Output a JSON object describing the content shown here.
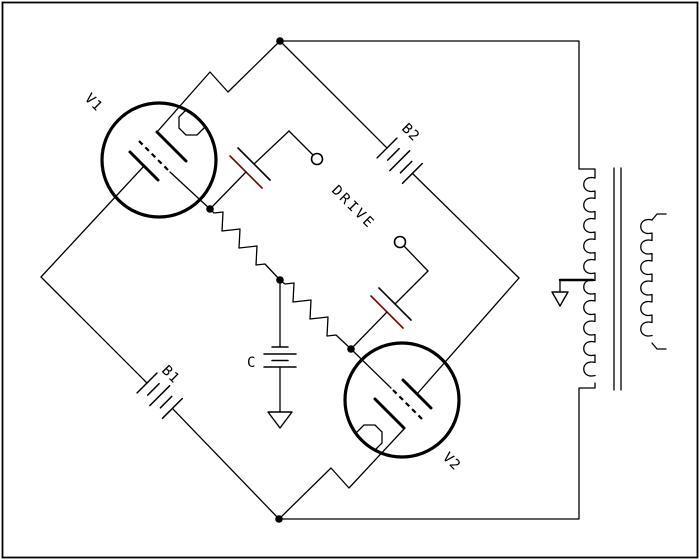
{
  "schematic": {
    "description": "Two-tube multivibrator oscillator schematic with cross-coupled grid network, drive terminals and output transformer",
    "labels": {
      "tube1": "V1",
      "tube2": "V2",
      "battery1": "B1",
      "battery2": "B2",
      "bias_battery": "C",
      "drive": "DRIVE"
    },
    "symbols": [
      "vacuum-tube-icon",
      "battery-icon",
      "capacitor-icon",
      "resistor-icon",
      "ground-arrow-icon",
      "transformer-coil-icon",
      "terminal-circle-icon"
    ],
    "colors": {
      "ink": "#000000",
      "capacitor_accent": "#7a0000",
      "paper": "#ffffff",
      "border": "#000000"
    }
  }
}
